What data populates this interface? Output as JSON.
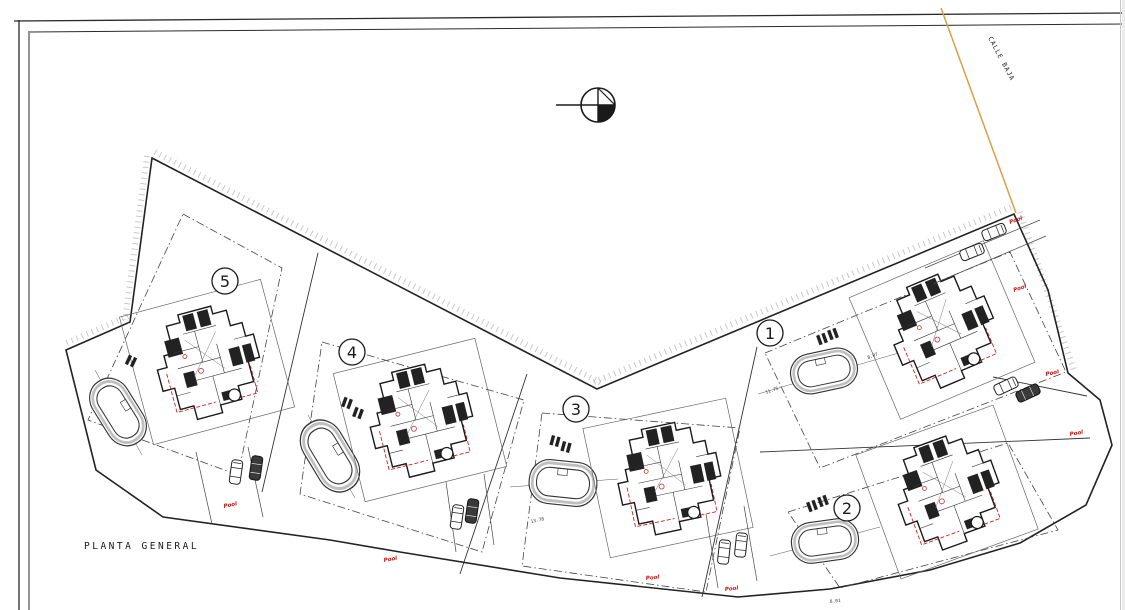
{
  "drawing": {
    "title": "PLANTA GENERAL",
    "street_label": "CALLE BAJA",
    "pool_label": "Pool",
    "plots": [
      {
        "number": "1"
      },
      {
        "number": "2"
      },
      {
        "number": "3"
      },
      {
        "number": "4"
      },
      {
        "number": "5"
      }
    ],
    "dimensions": [
      {
        "value": "8.07"
      },
      {
        "value": "11.75"
      },
      {
        "value": "13.78"
      },
      {
        "value": "8.01"
      }
    ],
    "colors": {
      "line": "#1a1a1a",
      "road_edge": "#dd9f45",
      "annotation_red": "#cc1111",
      "hatch_gray": "#c9c9c9"
    }
  }
}
